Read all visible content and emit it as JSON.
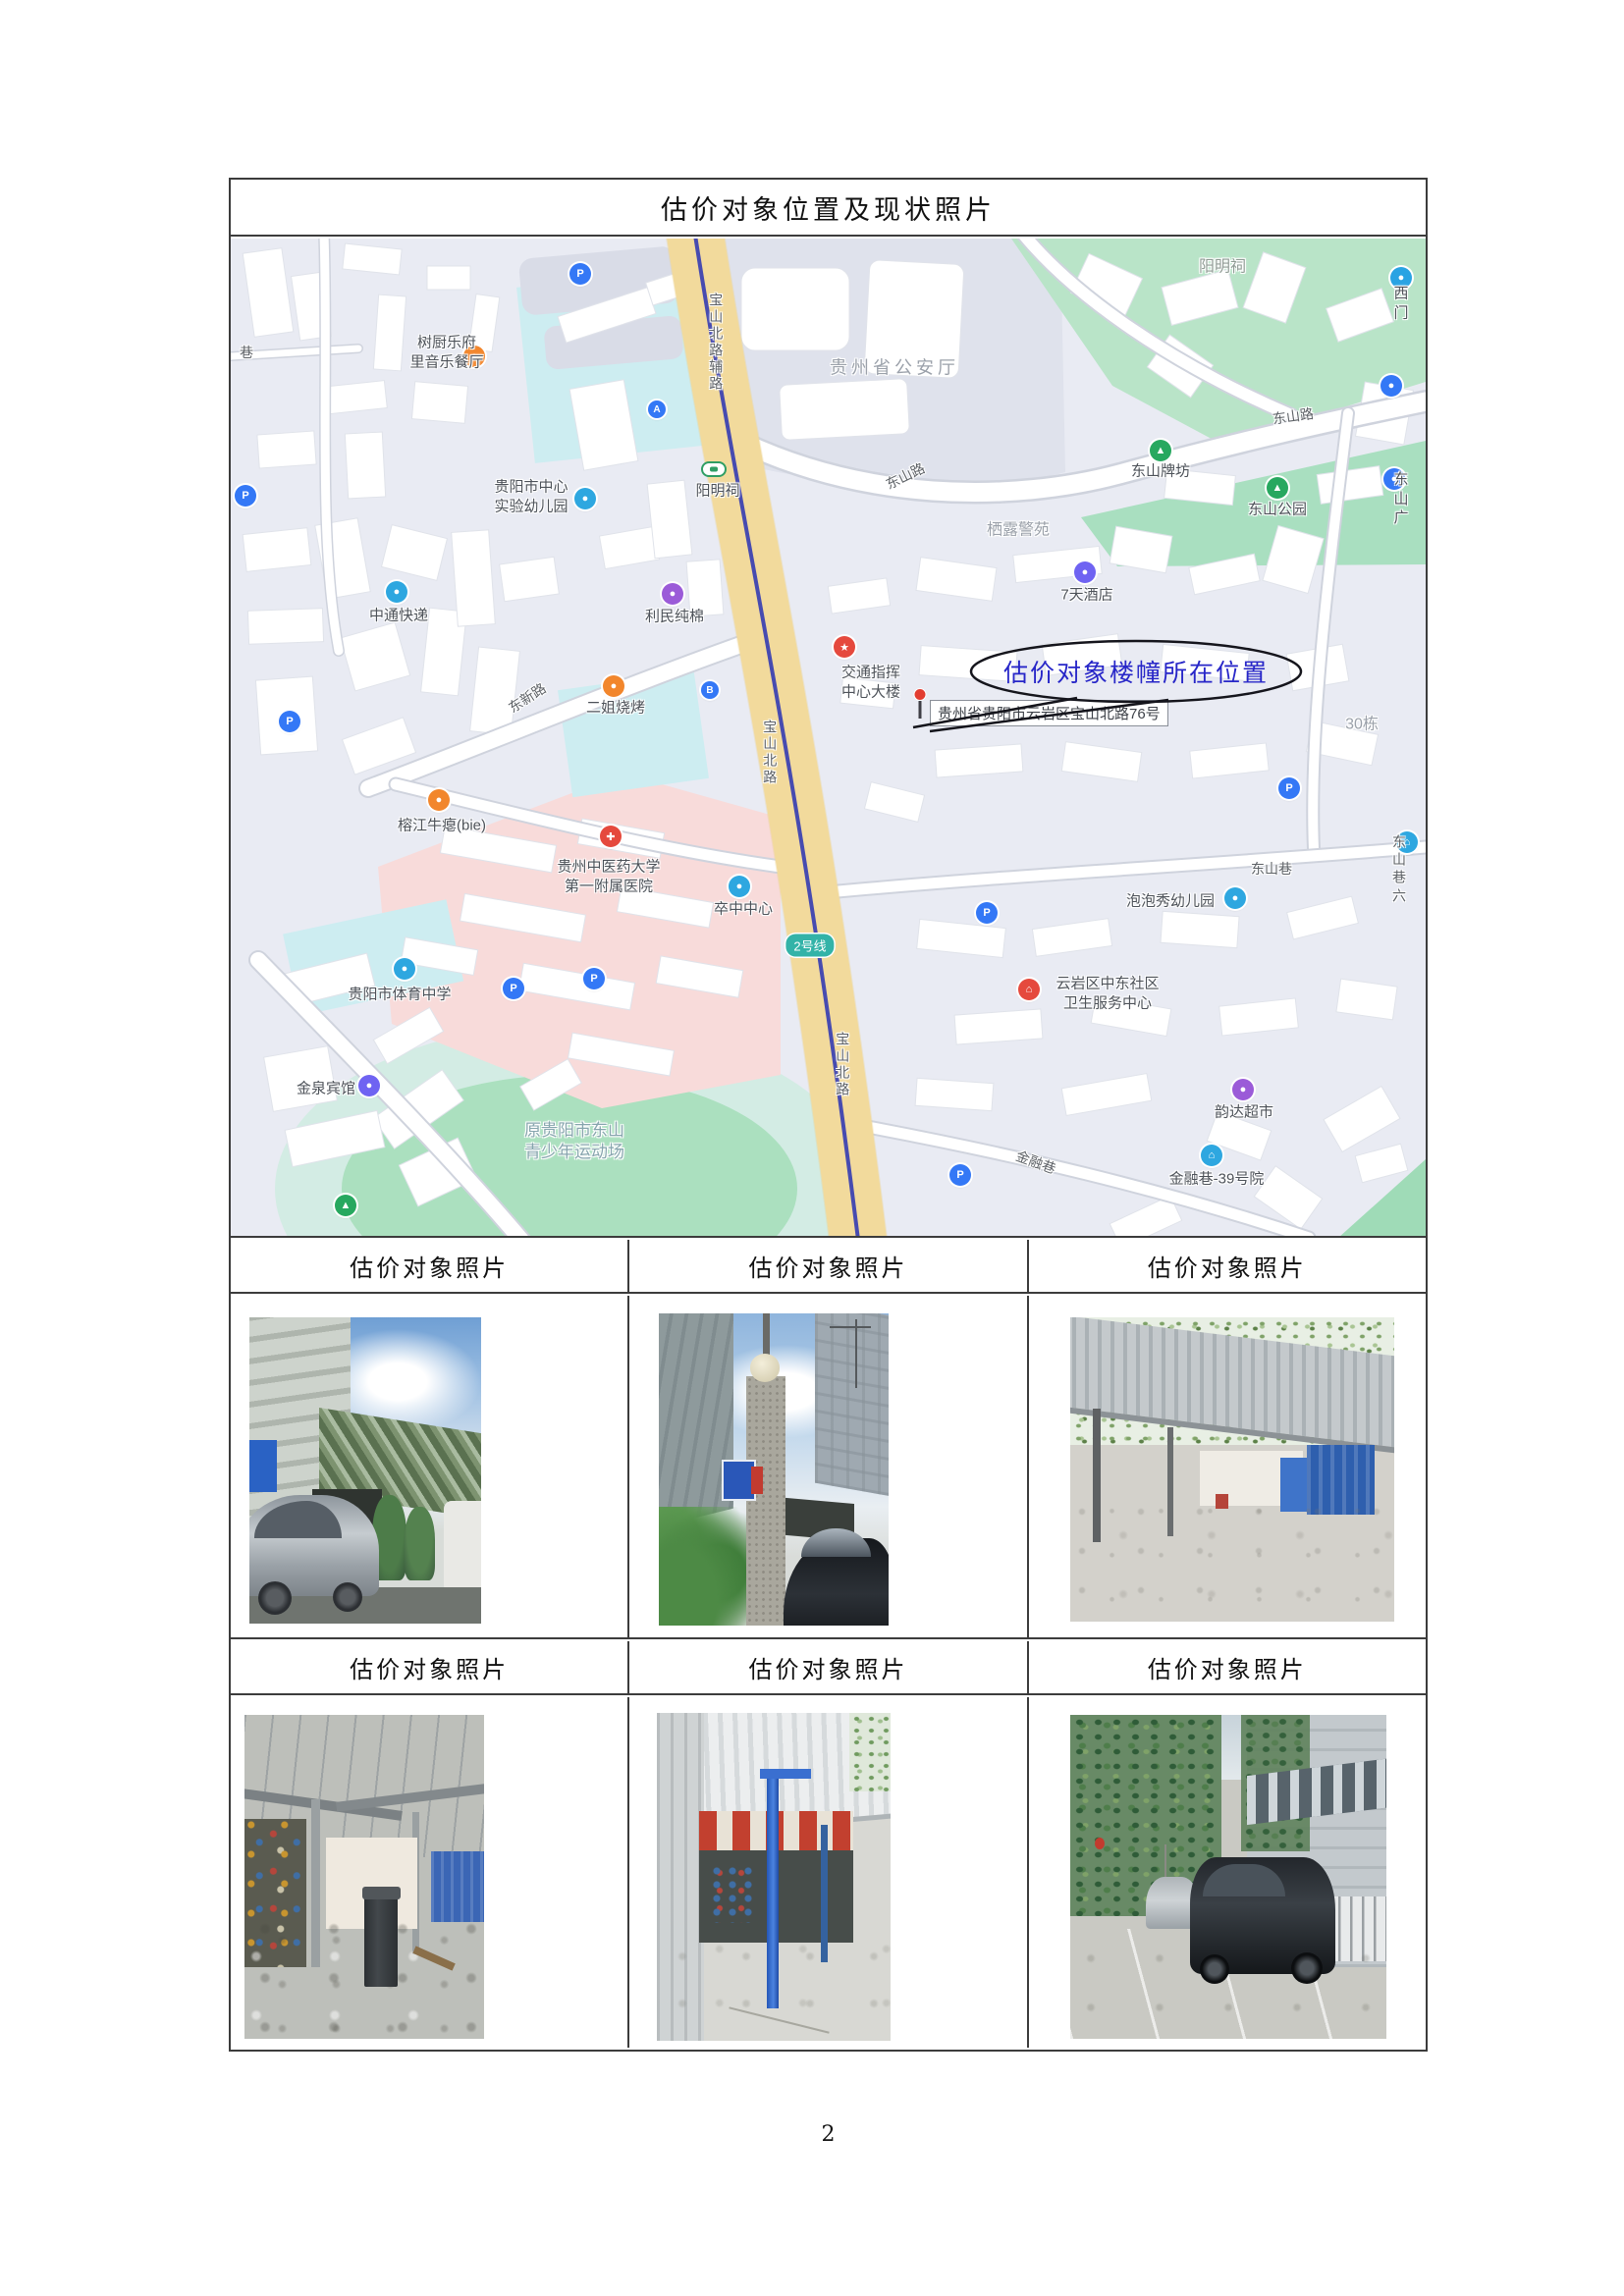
{
  "page": {
    "number": "2"
  },
  "table": {
    "title": "估价对象位置及现状照片",
    "photo_header": "估价对象照片"
  },
  "map": {
    "annotation": "估价对象楼幢所在位置",
    "address": "贵州省贵阳市云岩区宝山北路76号",
    "badges": {
      "line2": "2号线"
    },
    "glyphs": {
      "parking": "P",
      "exit_a": "A",
      "exit_b": "B",
      "cross": "✚",
      "star": "★",
      "tree": "▲",
      "dot": "●",
      "house": "⌂"
    },
    "labels": {
      "lane": "巷",
      "restaurant_shuchu": "树厨乐府\n里音乐餐厅",
      "kindergarten_center": "贵阳市中心\n实验幼儿园",
      "baoshan_fulu": "宝山北路辅路",
      "yangmingci_station": "阳明祠",
      "police_hq": "贵州省公安厅",
      "dongshan_road_1": "东山路",
      "dongshan_road_2": "东山路",
      "yangmingci_area": "阳明祠",
      "west_gate": "西门",
      "dongshan_paifang": "东山牌坊",
      "dongshan_park": "东山公园",
      "dongshan_plaza": "东山广",
      "zhongtong": "中通快递",
      "limin": "利民纯棉",
      "erjie_bbq": "二姐烧烤",
      "dongxin_road": "东新路",
      "traffic_center": "交通指挥\n中心大楼",
      "baoshan_mid": "宝山北路",
      "qilu": "栖露警苑",
      "hotel_7days": "7天酒店",
      "dong_30": "30栋",
      "dongshan_lane": "东山巷",
      "dongshan_lane6": "东山巷六",
      "paopao": "泡泡秀幼儿园",
      "community_health": "云岩区中东社区\n卫生服务中心",
      "yunda": "韵达超市",
      "jinrong_lane": "金融巷",
      "jinrong_39": "金融巷-39号院",
      "jinquan_hotel": "金泉宾馆",
      "stadium": "原贵阳市东山\n青少年运动场",
      "sports_school": "贵阳市体育中学",
      "stroke_center": "卒中中心",
      "tcm_hospital": "贵州中医药大学\n第一附属医院",
      "rongjiang": "榕江牛瘪(bie)",
      "baoshan_bottom": "宝山北路"
    }
  }
}
